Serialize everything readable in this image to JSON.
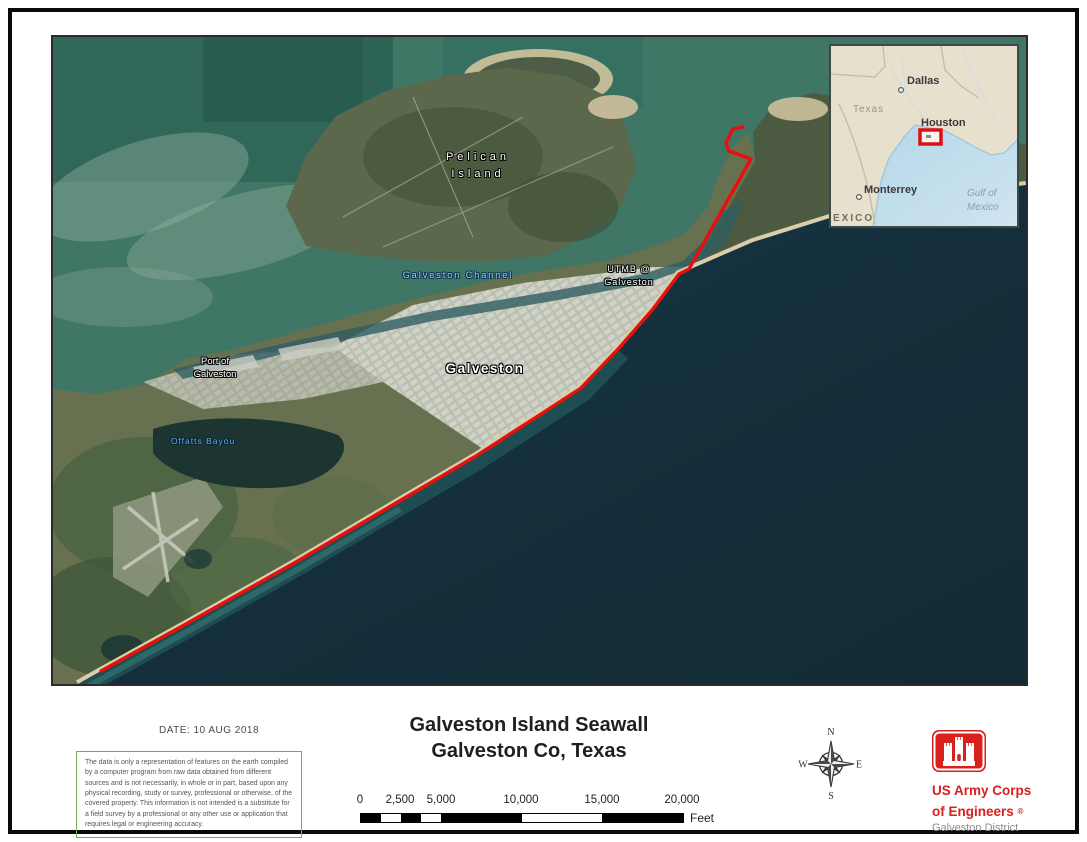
{
  "map": {
    "labels": {
      "pelican_island": {
        "line1": "Pelican",
        "line2": "Island"
      },
      "galveston_channel": "Galveston Channel",
      "utmb": {
        "line1": "UTMB @",
        "line2": "Galveston"
      },
      "port_of_galveston": {
        "line1": "Port of",
        "line2": "Galveston"
      },
      "galveston": "Galveston",
      "offatts_bayou": "Offatts Bayou"
    },
    "seawall_color": "#e8100c"
  },
  "inset": {
    "labels": {
      "dallas": "Dallas",
      "texas": "Texas",
      "houston": "Houston",
      "monterrey": "Monterrey",
      "gulf_line1": "Gulf of",
      "gulf_line2": "Mexico",
      "mexico": "EXICO"
    },
    "highlight_color": "#e01010"
  },
  "footer": {
    "date": "DATE: 10 AUG 2018",
    "disclaimer": "The data is only a representation of features on the earth compiled by a computer program from raw data obtained from different sources and is not necessarily, in whole or in part, based upon any physical recording, study or survey, professional or otherwise, of the covered property. This information is not intended is a substitute for a field survey by a professional or any other use or application that requires legal or engineering accuracy.",
    "title_line1": "Galveston Island Seawall",
    "title_line2": "Galveston Co, Texas",
    "scale_bar": {
      "labels": [
        "0",
        "2,500",
        "5,000",
        "10,000",
        "15,000",
        "20,000"
      ],
      "unit": "Feet"
    },
    "compass": {
      "n": "N",
      "e": "E",
      "s": "S",
      "w": "W"
    },
    "logo": {
      "line1": "US Army Corps",
      "line2": "of Engineers",
      "registered": "®",
      "line3": "Galveston District"
    }
  }
}
